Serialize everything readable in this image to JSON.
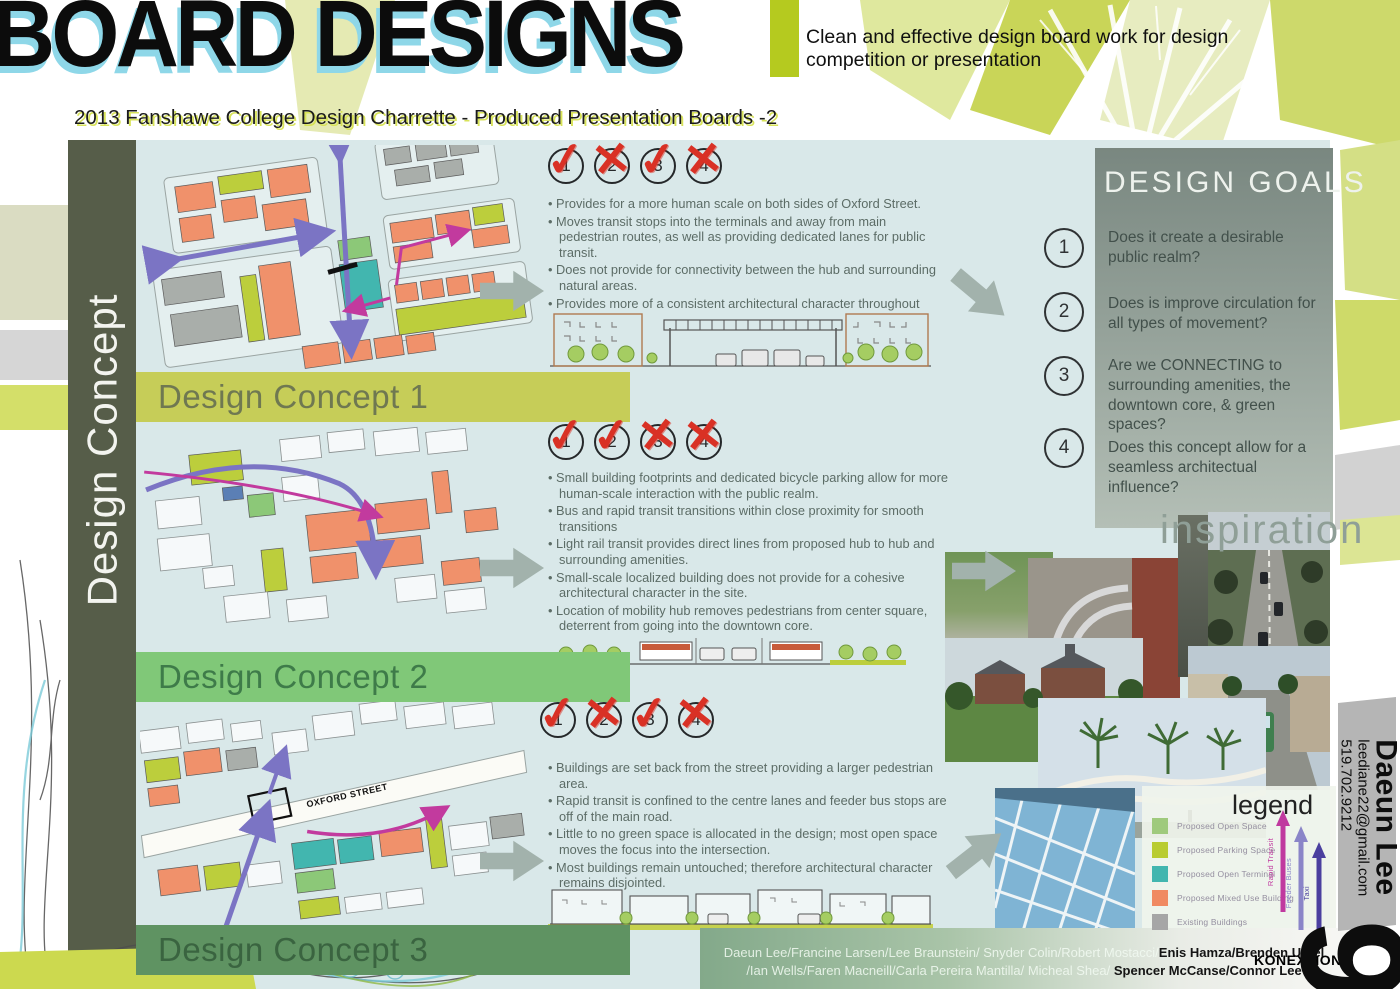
{
  "header": {
    "title": "BOARD DESIGNS",
    "tagline": "Clean and effective design board work for design competition or presentation",
    "subtitle": "2013 Fanshawe College Design Charrette - Produced Presentation Boards -2"
  },
  "sidebar": {
    "vertical_label": "Design Concept"
  },
  "design_goals": {
    "title": "DESIGN GOALS",
    "items": [
      {
        "number": "1",
        "text": "Does it create a desirable public realm?"
      },
      {
        "number": "2",
        "text": "Does is improve circulation for all types of movement?"
      },
      {
        "number": "3",
        "text": "Are we CONNECTING to surrounding amenities, the downtown core, & green spaces?"
      },
      {
        "number": "4",
        "text": "Does this concept allow for a seamless architectual influence?"
      }
    ]
  },
  "concepts": [
    {
      "label": "Design Concept 1",
      "banner_color": "#c6cd58",
      "label_color": "#6f7851",
      "marks": [
        "✓",
        "✕",
        "✓",
        "✕"
      ],
      "bullets": [
        "Provides for a more human scale on both sides of Oxford Street.",
        "Moves transit stops into the terminals and away from main pedestrian routes, as well as providing dedicated lanes for public transit.",
        "Does not provide for connectivity between the hub and surrounding natural areas.",
        "Provides more of a consistent architectural character throughout"
      ]
    },
    {
      "label": "Design Concept 2",
      "banner_color": "#80c878",
      "label_color": "#3e7b49",
      "marks": [
        "✓",
        "✓",
        "✕",
        "✕"
      ],
      "bullets": [
        "Small building footprints and dedicated bicycle parking allow for more human-scale interaction with the public realm.",
        "Bus and rapid transit transitions within close proximity for smooth transitions",
        "Light rail transit provides direct lines from proposed hub to hub and surrounding amenities.",
        "Small-scale localized building does not provide for a cohesive architectural character in the site.",
        "Location of mobility hub removes pedestrians from center square, deterrent from going into the downtown core."
      ]
    },
    {
      "label": "Design Concept 3",
      "banner_color": "#5f9362",
      "label_color": "#3a6440",
      "marks": [
        "✓",
        "✕",
        "✓",
        "✕"
      ],
      "map_label": "OXFORD STREET",
      "bullets": [
        "Buildings are set back from the street providing a larger pedestrian area.",
        "Rapid transit is confined to the centre lanes and feeder bus stops are off of the main road.",
        "Little to no green space is allocated in the design; most open space moves the focus into the intersection.",
        "Most buildings remain untouched; therefore architectural character remains disjointed."
      ]
    }
  ],
  "inspiration": {
    "title": "inspiration"
  },
  "legend": {
    "title": "legend",
    "items": [
      {
        "label": "Proposed Open Space",
        "color": "#9fca7d"
      },
      {
        "label": "Proposed Parking Space",
        "color": "#b9cc31"
      },
      {
        "label": "Proposed Open Terminal",
        "color": "#42b6af"
      },
      {
        "label": "Proposed Mixed Use Building",
        "color": "#f08a62"
      },
      {
        "label": "Existing Buildings",
        "color": "#a6a6a6"
      }
    ],
    "arrows": [
      {
        "label": "Rapid Transit",
        "color": "#c0399f"
      },
      {
        "label": "Feeder Buses",
        "color": "#8a85c8"
      },
      {
        "label": "Taxi",
        "color": "#4a3f9f"
      }
    ]
  },
  "credits": {
    "line1_light": "Daeun Lee/Francine Larsen/Lee Braunstein/ Snyder Colin/Robert Mostacci/",
    "line1_dark": "Enis Hamza/Brenden Ursel",
    "line2_light": "/Ian Wells/Faren Macneill/Carla Pereira Mantilla/ Micheal Shea/",
    "line2_dark": " Spencer McCanse/Connor Lee"
  },
  "contact": {
    "name": "Daeun Lee",
    "email": "leediane22@gmail.com",
    "phone": "519.702.9212",
    "board_number": "9",
    "studio": "KONEXTION"
  }
}
